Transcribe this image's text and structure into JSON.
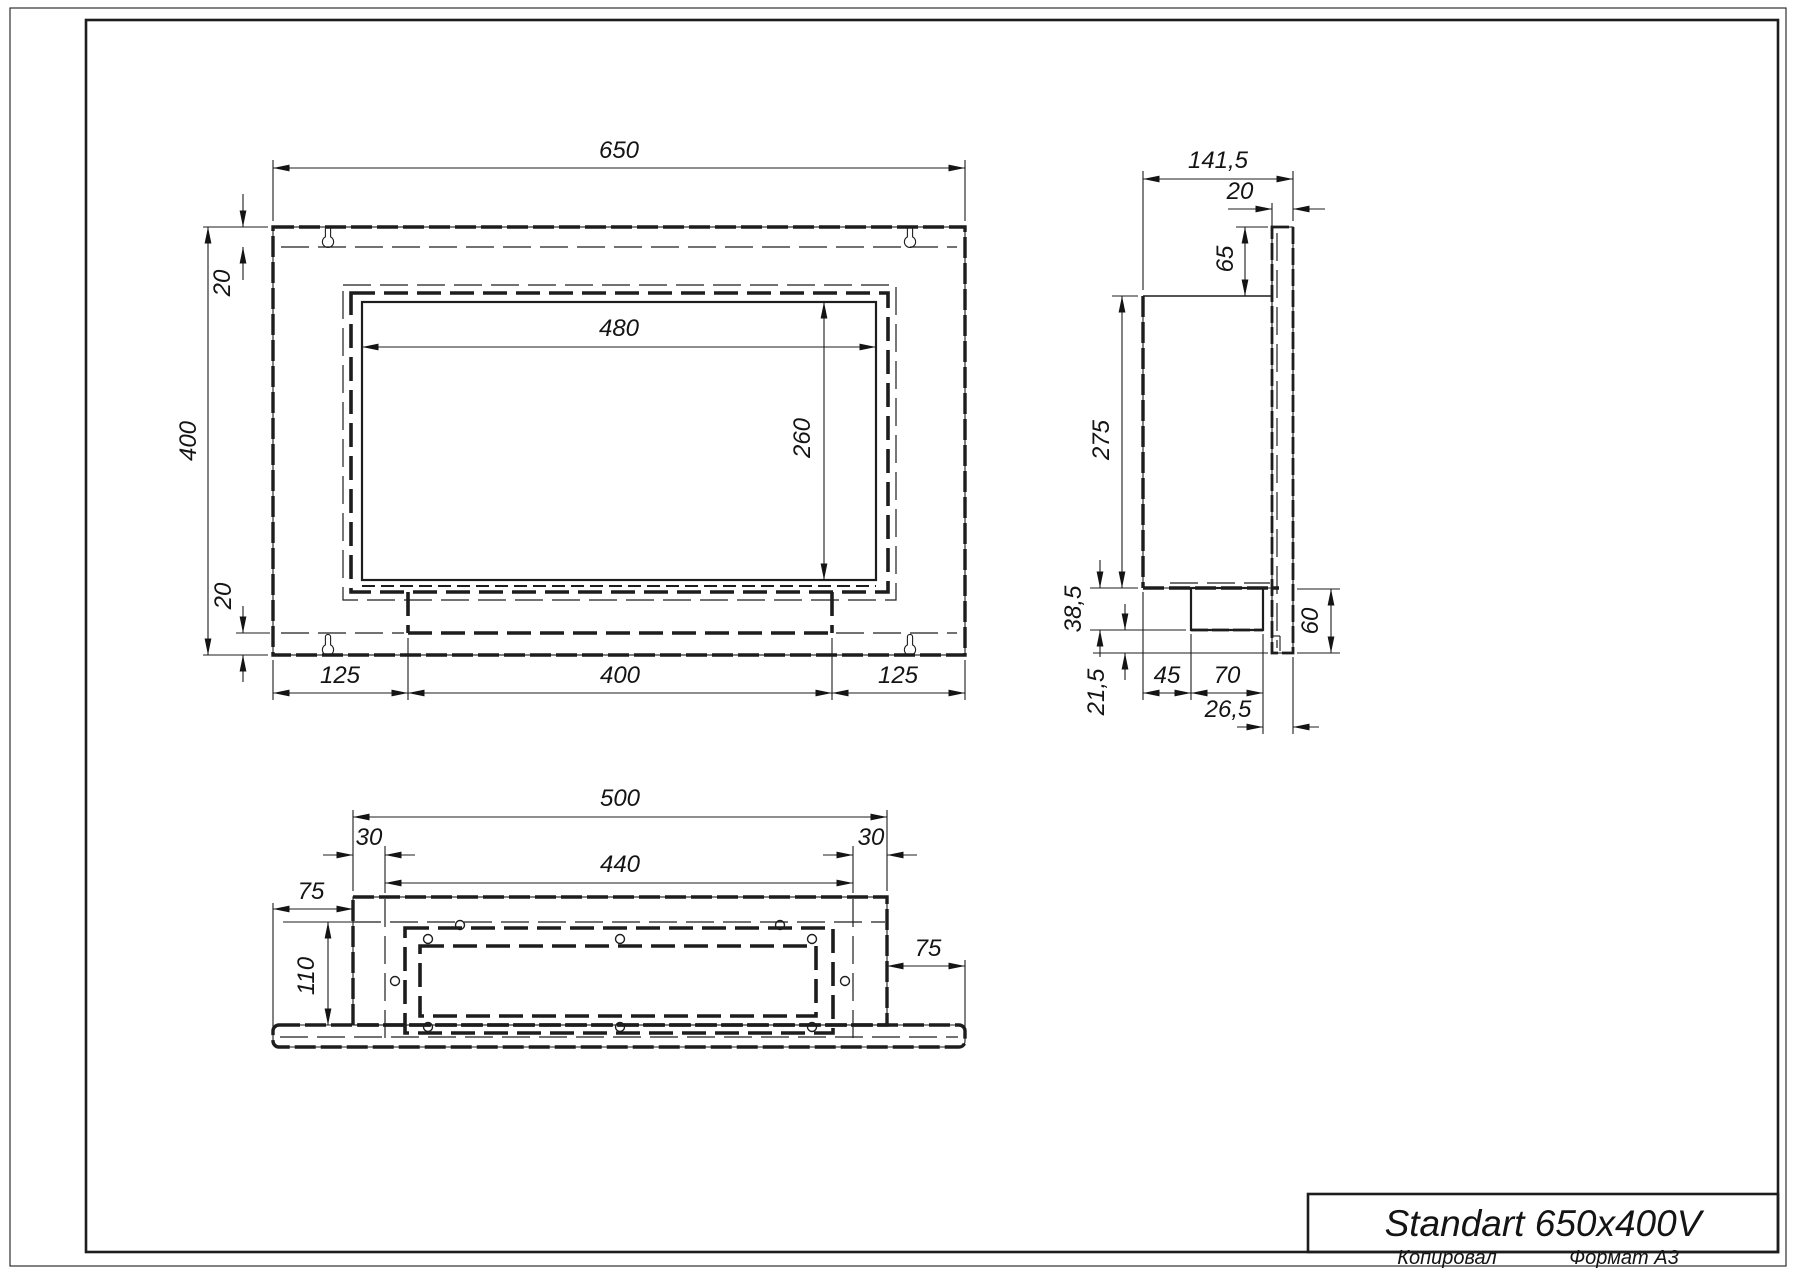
{
  "title_block": {
    "title": "Standart 650x400V"
  },
  "footer": {
    "copied_label": "Копировал",
    "format_label": "Формат А3"
  },
  "front_view": {
    "width": "650",
    "height": "400",
    "top_inset": "20",
    "bottom_inset": "20",
    "window_width": "480",
    "window_height": "260",
    "margin_left": "125",
    "tray_width": "400",
    "margin_right": "125"
  },
  "side_view": {
    "depth": "141,5",
    "flange_thickness": "20",
    "flange_top_offset": "65",
    "body_height": "275",
    "tray_depth": "38,5",
    "tray_lip": "21,5",
    "burner_offset": "45",
    "burner_width": "70",
    "corner_offset": "26,5",
    "bottom_height": "60"
  },
  "bottom_view": {
    "width": "500",
    "inset_left": "30",
    "inset_right": "30",
    "opening_width": "440",
    "wing_left": "75",
    "wing_right": "75",
    "depth": "110"
  }
}
